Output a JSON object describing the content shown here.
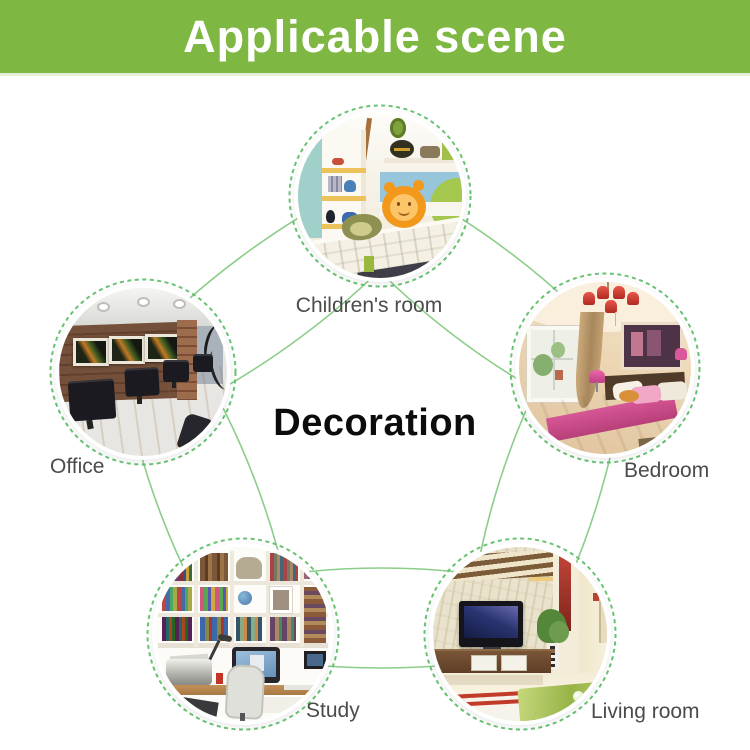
{
  "banner": {
    "title": "Applicable scene"
  },
  "center_label": "Decoration",
  "scenes": {
    "childrens_room": {
      "label": "Children's room"
    },
    "office": {
      "label": "Office"
    },
    "bedroom": {
      "label": "Bedroom"
    },
    "study": {
      "label": "Study"
    },
    "living_room": {
      "label": "Living room"
    }
  },
  "colors": {
    "banner_green": "#7eb843",
    "banner_text": "#ffffff",
    "connector_green": "#8ccd8a",
    "dash_green": "#69c373",
    "label_gray": "#4b4b49",
    "center_text": "#0c0c0c"
  }
}
